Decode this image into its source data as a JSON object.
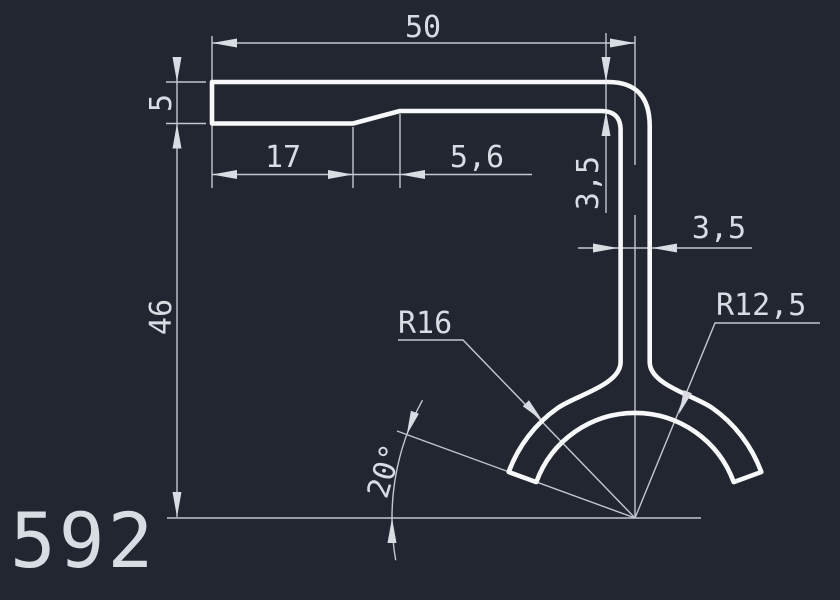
{
  "drawing": {
    "title": "CAD profile drawing",
    "part_number": "592",
    "dimensions": {
      "overall_width": "50",
      "flange_thickness": "5",
      "flat_length": "17",
      "taper_length": "5,6",
      "end_thickness": "3,5",
      "stem_thickness": "3,5",
      "overall_height": "46",
      "outer_radius": "R16",
      "inner_radius": "R12,5",
      "cut_angle": "20°"
    },
    "colors": {
      "background": "#212630",
      "profile": "#f7f8f9",
      "dimension_lines": "#c3c7ce",
      "dimension_text": "#d9dce2"
    }
  }
}
